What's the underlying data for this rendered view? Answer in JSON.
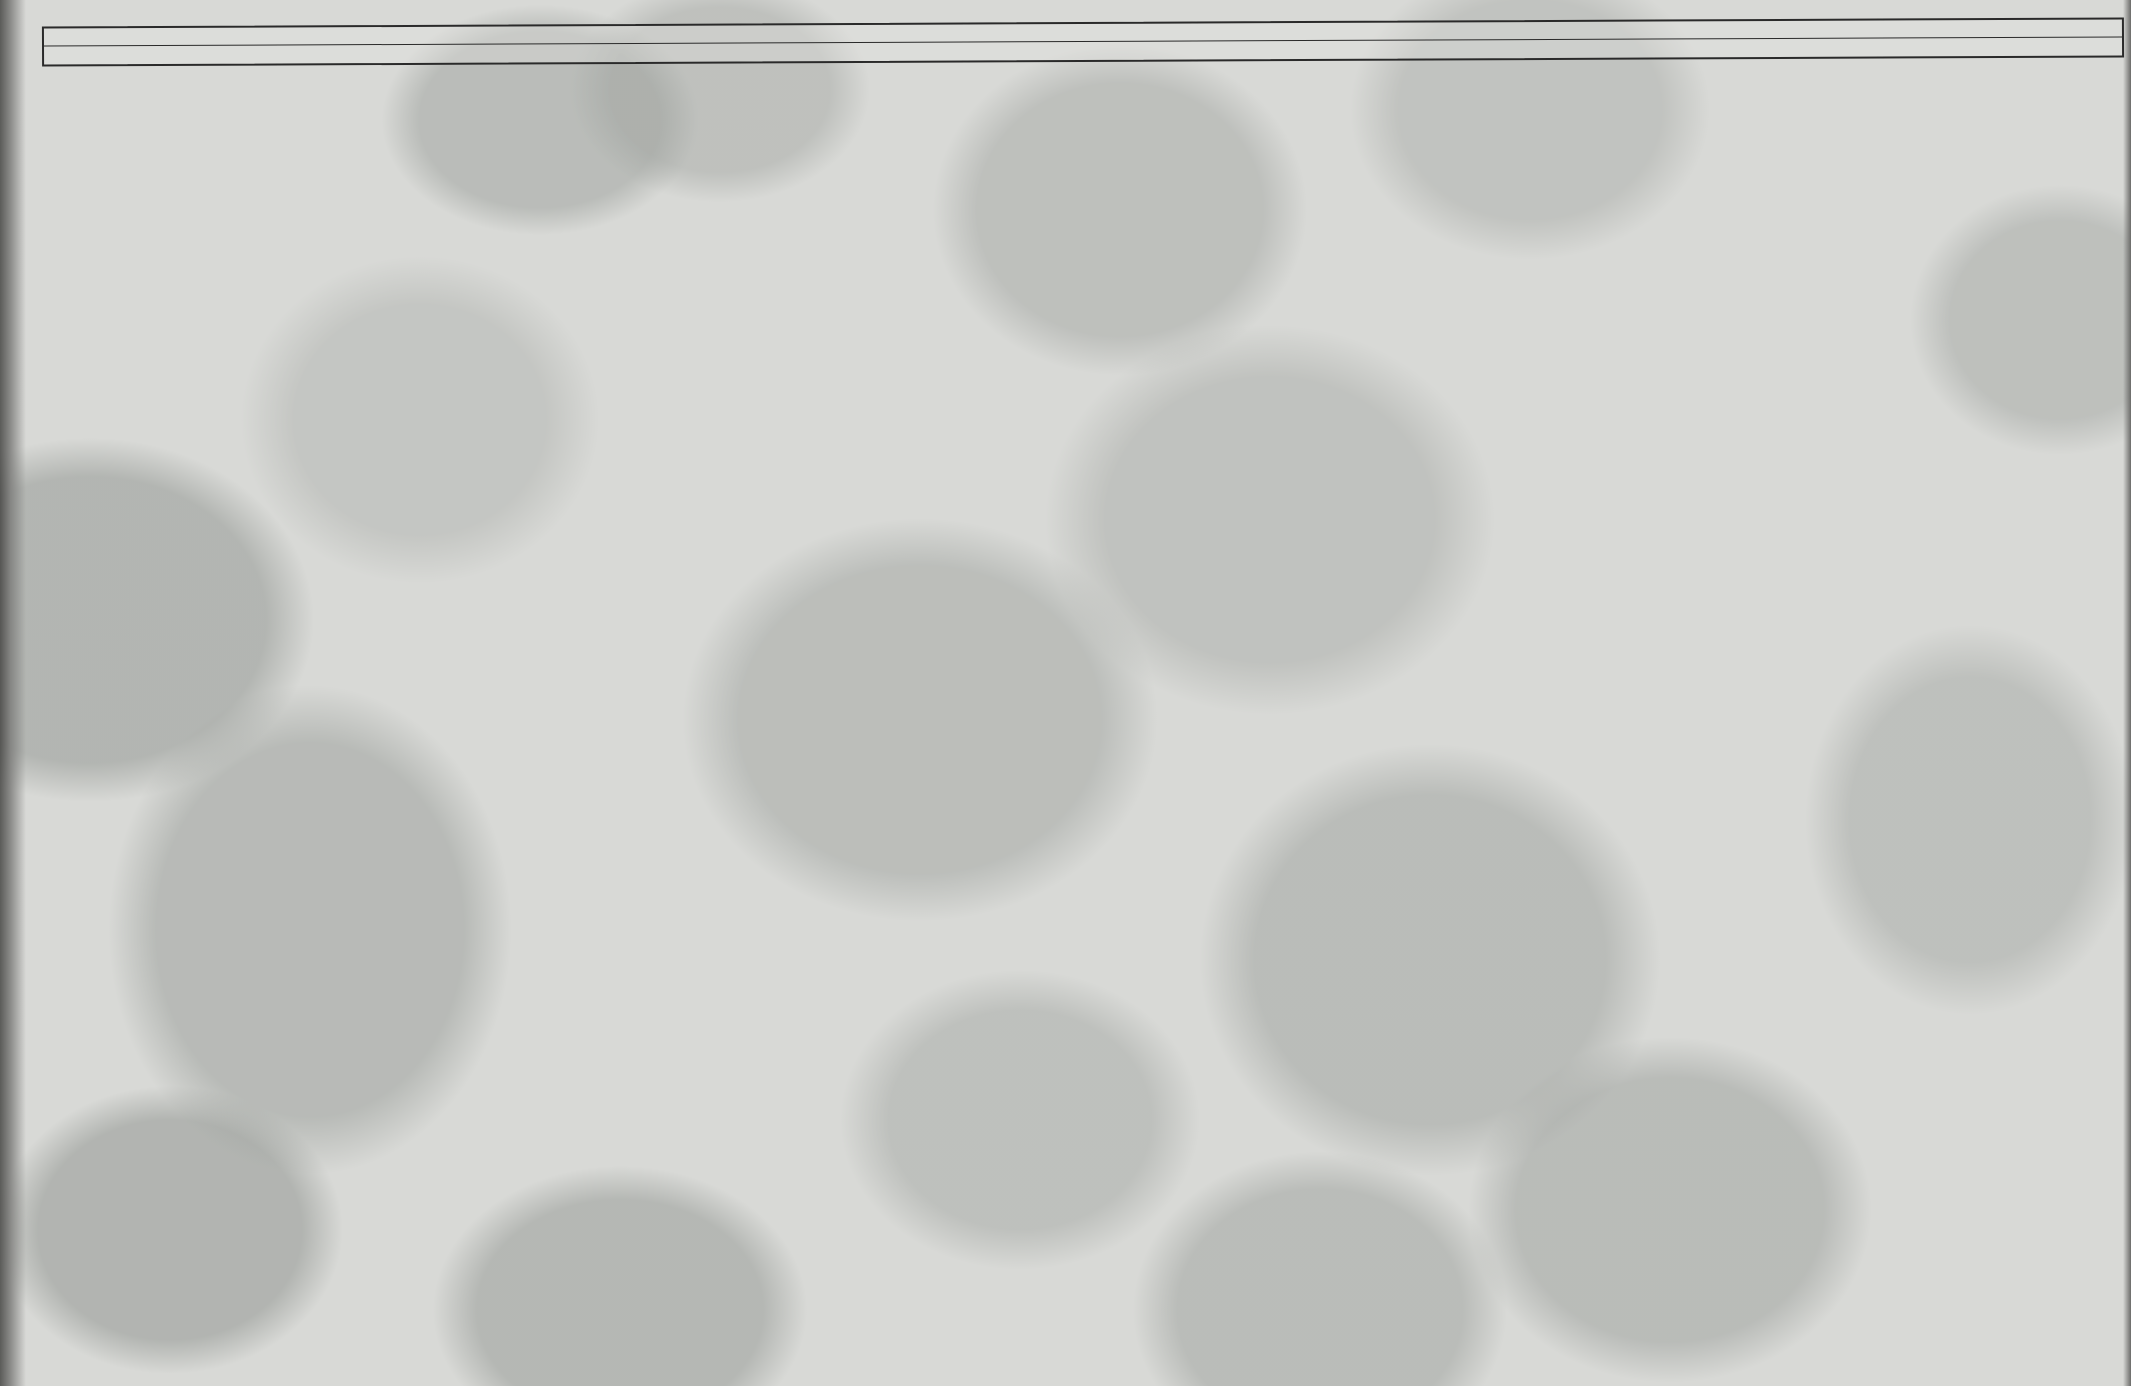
{
  "page": {
    "title": "SCHEMAT IDEOWY URZĄDZENIA KASETOWEGO MK 433"
  },
  "ruler": {
    "r_label": "R",
    "c_label": "C",
    "r_items": [
      {
        "t": "1",
        "x": 190
      },
      {
        "t": "2",
        "x": 245
      },
      {
        "t": "3",
        "x": 358
      },
      {
        "t": "45",
        "x": 425
      },
      {
        "t": "6",
        "x": 468
      },
      {
        "t": "7",
        "x": 500
      },
      {
        "t": "35",
        "x": 645
      },
      {
        "t": "8,9",
        "x": 680
      },
      {
        "t": "40,10,11,37",
        "x": 745
      },
      {
        "t": "12,16",
        "x": 800
      },
      {
        "t": "13,19,15",
        "x": 848
      },
      {
        "t": "16",
        "x": 898
      },
      {
        "t": "41",
        "x": 938
      },
      {
        "t": "36",
        "x": 1003
      },
      {
        "t": "21,32",
        "x": 1100
      },
      {
        "t": "20,22,38,33",
        "x": 1180
      },
      {
        "t": "23,24",
        "x": 1262
      },
      {
        "t": "25,26",
        "x": 1325
      },
      {
        "t": "27",
        "x": 1452
      },
      {
        "t": "28",
        "x": 1548
      },
      {
        "t": "29",
        "x": 1586
      },
      {
        "t": "30",
        "x": 1620
      },
      {
        "t": "31",
        "x": 1770
      }
    ],
    "c_items": [
      {
        "t": "1",
        "x": 140
      },
      {
        "t": "2,5",
        "x": 315
      },
      {
        "t": "4",
        "x": 358
      },
      {
        "t": "6",
        "x": 458
      },
      {
        "t": "7",
        "x": 498
      },
      {
        "t": "8",
        "x": 543
      },
      {
        "t": "9",
        "x": 608
      },
      {
        "t": "10",
        "x": 663
      },
      {
        "t": "36",
        "x": 765
      },
      {
        "t": "11,12",
        "x": 805
      },
      {
        "t": "13",
        "x": 945
      },
      {
        "t": "15,24",
        "x": 1090
      },
      {
        "t": "17",
        "x": 1138
      },
      {
        "t": "16",
        "x": 1205
      },
      {
        "t": "18,19,25,37",
        "x": 1258
      },
      {
        "t": "23",
        "x": 1370
      },
      {
        "t": "20",
        "x": 1412
      },
      {
        "t": "21",
        "x": 1462
      },
      {
        "t": "22,35",
        "x": 1518
      },
      {
        "t": "28",
        "x": 1608
      },
      {
        "t": "27",
        "x": 1648
      },
      {
        "t": "26,34",
        "x": 1692
      },
      {
        "t": "29",
        "x": 1772
      },
      {
        "t": "32,33,30",
        "x": 1822
      }
    ]
  },
  "tables": [
    {
      "id": "T1",
      "x": 315,
      "y": 775,
      "header": [
        "T1",
        "O",
        "Z"
      ],
      "rows": [
        [
          "E",
          "—",
          "0,1"
        ],
        [
          "B",
          "0,6",
          "0,68"
        ],
        [
          "C",
          "0,85",
          "0,9"
        ]
      ]
    },
    {
      "id": "T2",
      "x": 872,
      "y": 168,
      "header": [
        "T2",
        "O",
        "Z"
      ],
      "rows": [
        [
          "E",
          "2,3",
          "2,3"
        ],
        [
          "B",
          "2,8",
          "2,8"
        ],
        [
          "C",
          "6,6",
          "6,6"
        ]
      ]
    },
    {
      "id": "T3",
      "x": 1142,
      "y": 170,
      "header": [
        "T3",
        "O",
        "Z"
      ],
      "rows": [
        [
          "E",
          "7,4",
          "7,4"
        ],
        [
          "B",
          "6,75",
          "6,75"
        ],
        [
          "C",
          "3,4",
          "3,4"
        ]
      ]
    }
  ],
  "boxed_labels": [
    {
      "t": "6V",
      "x": 436,
      "y": 350
    },
    {
      "t": "7,4V",
      "x": 1160,
      "y": 350
    },
    {
      "t": "7,5V",
      "x": 1293,
      "y": 350
    }
  ],
  "labels": [
    {
      "t": "BC 239 C",
      "x": 343,
      "y": 345,
      "s": 26,
      "b": 1
    },
    {
      "t": "BC 238 C",
      "x": 497,
      "y": 345,
      "s": 26,
      "b": 1
    },
    {
      "t": "BC 238 C",
      "x": 610,
      "y": 345,
      "s": 26,
      "b": 1
    },
    {
      "t": "BC 308 B",
      "x": 737,
      "y": 345,
      "s": 26,
      "b": 1
    },
    {
      "t": "BC 238 C",
      "x": 618,
      "y": 960,
      "s": 24,
      "b": 1
    },
    {
      "t": "BC 308 B",
      "x": 900,
      "y": 960,
      "s": 24,
      "b": 1
    },
    {
      "t": "C5",
      "x": 272,
      "y": 338
    },
    {
      "t": "MW",
      "x": 350,
      "y": 306,
      "s": 11
    },
    {
      "t": "MW",
      "x": 296,
      "y": 390,
      "s": 11
    },
    {
      "t": "MW",
      "x": 296,
      "y": 652,
      "s": 11
    },
    {
      "t": "R1\n1M",
      "x": 186,
      "y": 406
    },
    {
      "t": "C1\n2,2µ\n1,6V",
      "x": 108,
      "y": 458
    },
    {
      "t": "R2\n12k",
      "x": 230,
      "y": 480
    },
    {
      "t": "C4\n220µ\n10V",
      "x": 372,
      "y": 426
    },
    {
      "t": "R5\n47k",
      "x": 420,
      "y": 460
    },
    {
      "t": "R3\n1M",
      "x": 356,
      "y": 510
    },
    {
      "t": "C2\n2,2µ\n16V",
      "x": 298,
      "y": 534
    },
    {
      "t": "T1",
      "x": 434,
      "y": 576,
      "s": 15,
      "b": 1
    },
    {
      "t": "C6\n560",
      "x": 458,
      "y": 552
    },
    {
      "t": "R7\n2,2k",
      "x": 498,
      "y": 558
    },
    {
      "t": "C3\n68nF",
      "x": 518,
      "y": 442
    },
    {
      "t": "R42",
      "x": 530,
      "y": 666
    },
    {
      "t": "T6",
      "x": 577,
      "y": 680,
      "s": 14,
      "b": 1
    },
    {
      "t": "R4",
      "x": 412,
      "y": 652
    },
    {
      "t": "R6\n240",
      "x": 452,
      "y": 652
    },
    {
      "t": "U 31.34.2",
      "x": 158,
      "y": 680,
      "s": 17,
      "b": 1
    },
    {
      "t": "R8\n1k",
      "x": 630,
      "y": 328
    },
    {
      "t": "R37\n2,2k",
      "x": 742,
      "y": 296
    },
    {
      "t": "R13\n6,8k",
      "x": 832,
      "y": 308
    },
    {
      "t": "C9\n0,3µ",
      "x": 598,
      "y": 370
    },
    {
      "t": "T2",
      "x": 718,
      "y": 388,
      "s": 15,
      "b": 1
    },
    {
      "t": "R12\n1k",
      "x": 778,
      "y": 350
    },
    {
      "t": "R14",
      "x": 756,
      "y": 410
    },
    {
      "t": "R9",
      "x": 628,
      "y": 444
    },
    {
      "t": "R11\n100",
      "x": 700,
      "y": 444
    },
    {
      "t": "R15",
      "x": 846,
      "y": 420
    },
    {
      "t": "C10",
      "x": 654,
      "y": 514
    },
    {
      "t": "C11\n4,7µ",
      "x": 690,
      "y": 514
    },
    {
      "t": "R10\n8,2k",
      "x": 724,
      "y": 500
    },
    {
      "t": "C12",
      "x": 790,
      "y": 500
    },
    {
      "t": "T3",
      "x": 904,
      "y": 364,
      "s": 15,
      "b": 1
    },
    {
      "t": "R36",
      "x": 980,
      "y": 348
    },
    {
      "t": "C13",
      "x": 928,
      "y": 394
    },
    {
      "t": "R16\n1k",
      "x": 888,
      "y": 476
    },
    {
      "t": "R41\n68Ω",
      "x": 920,
      "y": 544
    },
    {
      "t": "D5\nBAVP 17",
      "x": 882,
      "y": 576,
      "b": 1
    },
    {
      "t": "R19\n3,3k",
      "x": 928,
      "y": 622
    },
    {
      "t": "T5",
      "x": 588,
      "y": 598,
      "s": 15,
      "b": 1
    },
    {
      "t": "R35\n1k",
      "x": 626,
      "y": 654
    },
    {
      "t": "R40\n3,3k",
      "x": 694,
      "y": 628
    },
    {
      "t": "C36\n220µ\n6,3V",
      "x": 748,
      "y": 620
    },
    {
      "t": "C",
      "x": 804,
      "y": 622,
      "s": 12
    },
    {
      "t": "D",
      "x": 822,
      "y": 622,
      "s": 12
    },
    {
      "t": "C17\n100µ\n10V",
      "x": 1104,
      "y": 318
    },
    {
      "t": "R20\n10k",
      "x": 1108,
      "y": 358
    },
    {
      "t": "R38\n8,2",
      "x": 1200,
      "y": 294
    },
    {
      "t": "C23\n2200µ\n10V",
      "x": 1356,
      "y": 318
    },
    {
      "t": "C35\n100µ\n6,3V",
      "x": 1460,
      "y": 356
    },
    {
      "t": "R32\n82",
      "x": 1596,
      "y": 358
    },
    {
      "t": "C34\n100µ\n16V",
      "x": 1644,
      "y": 392
    },
    {
      "t": "R21\n10k",
      "x": 1076,
      "y": 406
    },
    {
      "t": "C15\n15n",
      "x": 1138,
      "y": 398
    },
    {
      "t": "C16",
      "x": 1190,
      "y": 398
    },
    {
      "t": "C14\n3,3nF",
      "x": 1222,
      "y": 400
    },
    {
      "t": "R25\n68k",
      "x": 1300,
      "y": 400
    },
    {
      "t": "R22\n470k",
      "x": 1126,
      "y": 446
    },
    {
      "t": "R23\n27k",
      "x": 1188,
      "y": 462
    },
    {
      "t": "R24\n100k",
      "x": 1242,
      "y": 464
    },
    {
      "t": "C19",
      "x": 1144,
      "y": 490
    },
    {
      "t": "R26\n820",
      "x": 1222,
      "y": 506
    },
    {
      "t": "R33\n10k",
      "x": 1124,
      "y": 570
    },
    {
      "t": "C25\n560p",
      "x": 1316,
      "y": 566
    },
    {
      "t": "C24\n1nF",
      "x": 1092,
      "y": 618
    },
    {
      "t": "C37\n560p",
      "x": 1236,
      "y": 614
    },
    {
      "t": "C21\n15n",
      "x": 1418,
      "y": 798
    },
    {
      "t": "C22\n2,2n",
      "x": 1458,
      "y": 762
    },
    {
      "t": "R27\n220k",
      "x": 1446,
      "y": 676
    },
    {
      "t": "UL 1497 R",
      "x": 1520,
      "y": 648,
      "s": 19,
      "b": 1
    },
    {
      "t": "2",
      "x": 1530,
      "y": 620,
      "s": 11
    },
    {
      "t": "1",
      "x": 1600,
      "y": 642,
      "s": 11
    },
    {
      "t": "12",
      "x": 1620,
      "y": 634,
      "s": 11
    },
    {
      "t": "3",
      "x": 1606,
      "y": 662,
      "s": 11
    },
    {
      "t": "5",
      "x": 1580,
      "y": 668,
      "s": 11
    },
    {
      "t": "10",
      "x": 1550,
      "y": 680,
      "s": 11
    },
    {
      "t": "8",
      "x": 1532,
      "y": 694,
      "s": 11
    },
    {
      "t": "A",
      "x": 1710,
      "y": 616,
      "s": 13,
      "b": 1
    },
    {
      "t": "10",
      "x": 1718,
      "y": 638,
      "s": 10
    },
    {
      "t": "11",
      "x": 1718,
      "y": 650,
      "s": 10
    },
    {
      "t": "12",
      "x": 1718,
      "y": 666,
      "s": 10
    },
    {
      "t": "C26\n100",
      "x": 1648,
      "y": 670
    },
    {
      "t": "C27\n560p",
      "x": 1626,
      "y": 706
    },
    {
      "t": "R28\n10k",
      "x": 1528,
      "y": 780
    },
    {
      "t": "R29\n150",
      "x": 1584,
      "y": 790
    },
    {
      "t": "C28\n6,3V",
      "x": 1584,
      "y": 838
    },
    {
      "t": "MIK",
      "x": 1592,
      "y": 754,
      "s": 10
    },
    {
      "t": "MIK",
      "x": 1748,
      "y": 756,
      "s": 10
    },
    {
      "t": "C29\n10µ",
      "x": 1742,
      "y": 710
    },
    {
      "t": "R30\n1",
      "x": 1768,
      "y": 676
    },
    {
      "t": "C30\n470p",
      "x": 1810,
      "y": 604
    },
    {
      "t": "GS-2-7",
      "x": 1820,
      "y": 718,
      "s": 16,
      "b": 1
    },
    {
      "t": "GD 10/1,5/4-6Ω",
      "x": 1798,
      "y": 930,
      "s": 17,
      "b": 1
    },
    {
      "t": "S1 L3,8",
      "x": 1554,
      "y": 974,
      "s": 15,
      "b": 1
    },
    {
      "t": "VZ2-07",
      "x": 1770,
      "y": 214,
      "s": 15,
      "b": 1
    },
    {
      "t": "7,5V",
      "x": 1920,
      "y": 314,
      "s": 14,
      "b": 1
    },
    {
      "t": "WTAT 630 mA",
      "x": 1810,
      "y": 348,
      "s": 11
    },
    {
      "t": "C33\n6,8n",
      "x": 1786,
      "y": 398
    },
    {
      "t": "C32\n6,8n",
      "x": 1786,
      "y": 484
    },
    {
      "t": "D1÷D4",
      "x": 1850,
      "y": 518,
      "s": 12,
      "b": 1
    },
    {
      "t": "4×BYP 401-100",
      "x": 1808,
      "y": 552,
      "s": 12,
      "b": 1
    },
    {
      "t": "TS 4/7",
      "x": 1946,
      "y": 510,
      "s": 16,
      "b": 1
    },
    {
      "t": "II",
      "x": 36,
      "y": 222,
      "s": 20,
      "b": 1
    },
    {
      "t": "O",
      "x": 33,
      "y": 252,
      "s": 20,
      "b": 1
    },
    {
      "t": "O",
      "x": 33,
      "y": 282,
      "s": 20,
      "b": 1
    },
    {
      "t": "C",
      "x": 2062,
      "y": 686,
      "s": 26,
      "b": 1,
      "r": 90
    },
    {
      "t": "B",
      "x": 2062,
      "y": 738,
      "s": 26,
      "b": 1,
      "r": 90
    }
  ],
  "notes": {
    "heading": "UWAGI:",
    "line1": "1. Napięcia zmierzone odnośnie masy (-zasilanie)",
    "line2": "woltomierzem o rezystancji wejściowej ≥ 1 MΩ."
  },
  "switches": {
    "p1": {
      "label": "Przełącznik P1",
      "mode": "Zapis — Odczyt",
      "view": "widok od strony elementów",
      "a": "A",
      "b": "B"
    },
    "p2": {
      "label": "Przełącznik P2 wył.AUT",
      "on": "WŁĄCZ.",
      "off": "WYŁĄCZ.",
      "c": "C",
      "d": "D"
    }
  },
  "legend": {
    "transistors": [
      "BC 238",
      "BC 239",
      "BC 308"
    ],
    "ic": "UL 1497 R",
    "pins_top": "7 6 5 4 3 2 1",
    "pins_bottom": "8 9 10 11 12 13 14"
  },
  "part_numbers": {
    "motor": "3 409-5478-171-029",
    "board": "412-5478-175-04"
  },
  "motor_box": {
    "label": "Zespół\nsilnika"
  },
  "ink": "#262626"
}
